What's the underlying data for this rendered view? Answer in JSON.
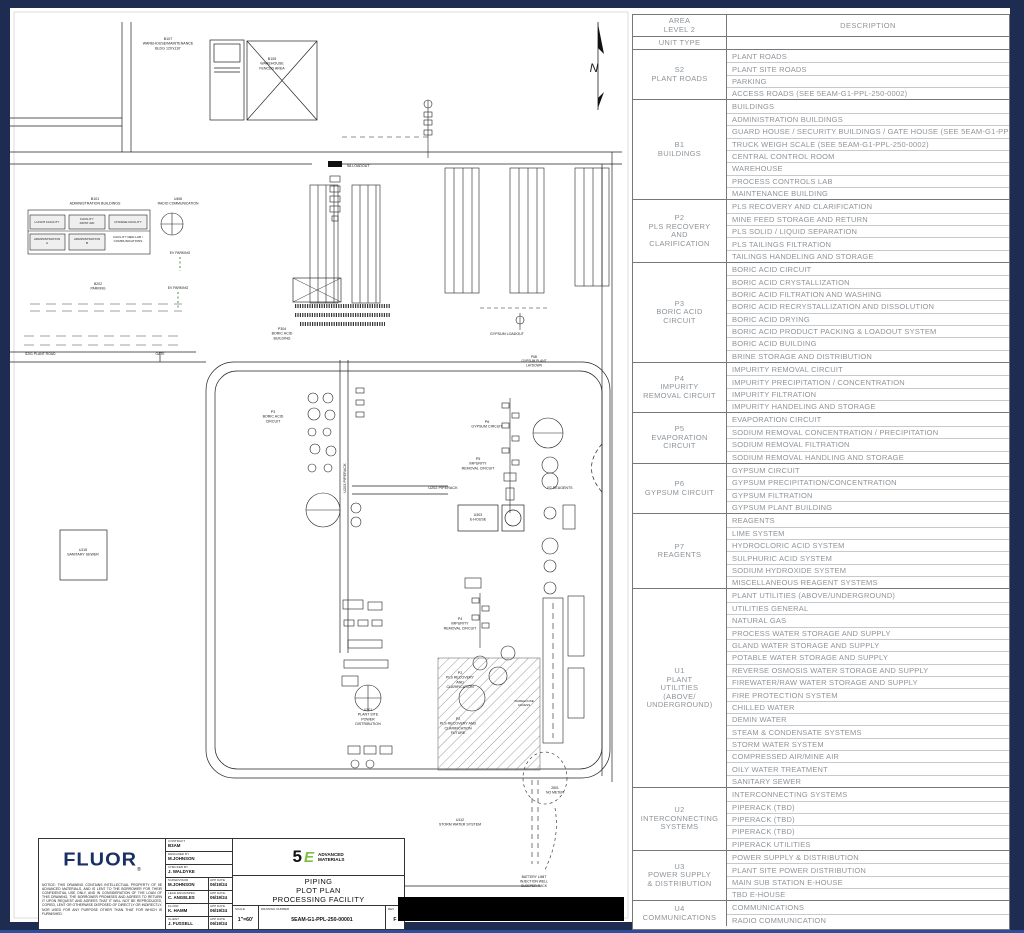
{
  "colors": {
    "frame_navy": "#1d2c50",
    "frame_accent": "#2c4e9b",
    "sheet_white": "#ffffff",
    "line_black": "#1a1a1a",
    "table_text_gray": "#8f9499",
    "fluor_blue": "#1a2f63",
    "five_e_green": "#7fbf3f",
    "ev_green": "#3a9948",
    "redaction_black": "#000000"
  },
  "plot_labels": [
    {
      "name": "north",
      "lines": [
        "N"
      ],
      "x": 584,
      "y": 64,
      "size": 12,
      "style": "italic"
    },
    {
      "name": "b107-warehouse-maintenance",
      "lines": [
        "B107",
        "WAREHOUSE/MAINTENANCE",
        "BLDG 120'x110'"
      ],
      "x": 158,
      "y": 32,
      "size": 3.6
    },
    {
      "name": "b105-warehouse-fenced-area",
      "lines": [
        "B105",
        "WAREHOUSE",
        "FENCED AREA"
      ],
      "x": 262,
      "y": 52,
      "size": 3.6
    },
    {
      "name": "b101-administration-buildings",
      "lines": [
        "B101",
        "ADMINISTRATION BUILDINGS"
      ],
      "x": 85,
      "y": 192,
      "size": 3.6
    },
    {
      "name": "lunch-facility",
      "lines": [
        "LUNCH FACILITY"
      ],
      "x": 37,
      "y": 215,
      "size": 3.1
    },
    {
      "name": "facility-first-aid",
      "lines": [
        "FACILITY",
        "FIRST AID"
      ],
      "x": 77,
      "y": 212,
      "size": 3.1
    },
    {
      "name": "change-facility",
      "lines": [
        "CHANGE FACILITY"
      ],
      "x": 118,
      "y": 215,
      "size": 3.1
    },
    {
      "name": "administration-a",
      "lines": [
        "ADMINISTRATION",
        "A"
      ],
      "x": 37,
      "y": 232,
      "size": 3.1
    },
    {
      "name": "administration-b",
      "lines": [
        "ADMINISTRATION",
        "B"
      ],
      "x": 77,
      "y": 232,
      "size": 3.1
    },
    {
      "name": "facility-med-lab",
      "lines": [
        "FACILITY MED LAB /",
        "COMMUNICATIONS"
      ],
      "x": 118,
      "y": 230,
      "size": 3.1
    },
    {
      "name": "u408-radio-communication",
      "lines": [
        "U408",
        "RADIO COMMUNICATION"
      ],
      "x": 168,
      "y": 192,
      "size": 3.4
    },
    {
      "name": "ev-parking-1",
      "lines": [
        "EV PARKING"
      ],
      "x": 170,
      "y": 246,
      "size": 3.4
    },
    {
      "name": "b202-parking",
      "lines": [
        "B202",
        "PARKING"
      ],
      "x": 88,
      "y": 277,
      "size": 3.4
    },
    {
      "name": "ev-parking-2",
      "lines": [
        "EV PARKING"
      ],
      "x": 168,
      "y": 281,
      "size": 3.4
    },
    {
      "name": "s201-plant-road",
      "lines": [
        "S201 PLANT ROAD"
      ],
      "x": 15,
      "y": 347,
      "size": 3.4,
      "anchor": "start"
    },
    {
      "name": "gate",
      "lines": [
        "GATE"
      ],
      "x": 150,
      "y": 347,
      "size": 3.4
    },
    {
      "name": "u115-sanitary-sewer",
      "lines": [
        "U115",
        "SANITARY SEWER"
      ],
      "x": 73,
      "y": 543,
      "size": 3.6
    },
    {
      "name": "5a-loadout",
      "lines": [
        "5A LOADOUT"
      ],
      "x": 337,
      "y": 159,
      "size": 3.6,
      "anchor": "start"
    },
    {
      "name": "p304-boric-acid-building",
      "lines": [
        "P304",
        "BORIC ACID",
        "BUILDING"
      ],
      "x": 272,
      "y": 322,
      "size": 3.6
    },
    {
      "name": "p3-boric-acid-circuit",
      "lines": [
        "P3",
        "BORIC ACID",
        "CIRCUIT"
      ],
      "x": 263,
      "y": 405,
      "size": 3.6
    },
    {
      "name": "u203-piperack",
      "lines": [
        "U203 PIPERACK"
      ],
      "x": 336,
      "y": 470,
      "size": 3.8,
      "rotate": -90
    },
    {
      "name": "gypsum-loadout",
      "lines": [
        "GYPSUM LOADOUT"
      ],
      "x": 497,
      "y": 327,
      "size": 3.6
    },
    {
      "name": "p6b-gypsum-loadout",
      "lines": [
        "P6B",
        "GYPSUM PLANT",
        "LAYDOWN"
      ],
      "x": 524,
      "y": 350,
      "size": 3.2
    },
    {
      "name": "p6-gypsum-circuit",
      "lines": [
        "P6",
        "GYPSUM CIRCUIT"
      ],
      "x": 477,
      "y": 415,
      "size": 3.6
    },
    {
      "name": "p5-impurity-removal-circuit",
      "lines": [
        "P5",
        "IMPURITY",
        "REMOVAL CIRCUIT"
      ],
      "x": 468,
      "y": 452,
      "size": 3.6
    },
    {
      "name": "u202-piperack",
      "lines": [
        "U202 PIPERACK"
      ],
      "x": 433,
      "y": 481,
      "size": 3.8
    },
    {
      "name": "u303-e-house",
      "lines": [
        "U303",
        "E-HOUSE"
      ],
      "x": 468,
      "y": 508,
      "size": 3.6
    },
    {
      "name": "p7-reagents",
      "lines": [
        "P7 REAGENTS"
      ],
      "x": 550,
      "y": 481,
      "size": 3.6
    },
    {
      "name": "p4-impurity-removal-circuit",
      "lines": [
        "P4",
        "IMPURITY",
        "REMOVAL CIRCUIT"
      ],
      "x": 450,
      "y": 612,
      "size": 3.6
    },
    {
      "name": "p2-pls-recovery",
      "lines": [
        "P2",
        "PLS RECOVERY",
        "AND",
        "CLARIFICATION"
      ],
      "x": 450,
      "y": 666,
      "size": 3.6
    },
    {
      "name": "p2-pls-recovery-future",
      "lines": [
        "P2",
        "PLS RECOVERY AND",
        "CLARIFICATION",
        "FUTURE"
      ],
      "x": 448,
      "y": 712,
      "size": 3.6
    },
    {
      "name": "u301-plant-site-power",
      "lines": [
        "U301",
        "PLANT SITE",
        "POWER",
        "DISTRIBUTION"
      ],
      "x": 358,
      "y": 703,
      "size": 3.6
    },
    {
      "name": "warehouse-access",
      "lines": [
        "WAREHOUSE",
        "ACCESS"
      ],
      "x": 514,
      "y": 694,
      "size": 3
    },
    {
      "name": "u112-storm-water-system",
      "lines": [
        "U112",
        "STORM WATER SYSTEM"
      ],
      "x": 450,
      "y": 813,
      "size": 3.6
    },
    {
      "name": "no-meter",
      "lines": [
        "2801",
        "NO METER"
      ],
      "x": 545,
      "y": 781,
      "size": 3.4
    },
    {
      "name": "battery-limit",
      "lines": [
        "BATTERY LIMIT",
        "INJECTION WELL",
        "SLEEPER RACK"
      ],
      "x": 524,
      "y": 870,
      "size": 3.4
    }
  ],
  "title_block": {
    "fluor_logo": "FLUOR",
    "registered_mark": "®",
    "notice": "NOTICE: THIS DRAWING CONTAINS INTELLECTUAL PROPERTY OF 5E ADVANCED MATERIALS, AND IS LENT TO THE BORROWER FOR THEIR CONFIDENTIAL USE ONLY, AND IN CONSIDERATION OF THE LOAN OF THIS DRAWING, THE BORROWER PROMISES AND AGREES TO RETURN IT UPON REQUEST AND AGREES THAT IT WILL NOT BE REPRODUCED, COPIED, LENT OR OTHERWISE DISPOSED OF DIRECTLY OR INDIRECTLY, NOR USED FOR ANY PURPOSE OTHER THAN THAT FOR WHICH IS FURNISHED.",
    "app_date_label": "APP DATE",
    "fields": [
      {
        "label": "CONTRACT",
        "value": "B3AM"
      },
      {
        "label": "DESIGNED BY",
        "value": "M.JOHNSON"
      },
      {
        "label": "CHECKED BY",
        "value": "J. WALDYKE"
      },
      {
        "label": "SUPERVISOR",
        "value": "M.JOHNSON",
        "app_date": "06/19/24"
      },
      {
        "label": "LEAD ENGR/SPEC",
        "value": "C. ANGELES",
        "app_date": "06/19/24"
      },
      {
        "label": "FLUOR",
        "value": "K. HAMM",
        "app_date": "06/19/24"
      },
      {
        "label": "CLIENT",
        "value": "J. FUSSELL",
        "app_date": "06/19/24"
      }
    ],
    "logo_5e": {
      "numeral": "5",
      "letter": "E",
      "name_line1": "ADVANCED",
      "name_line2": "MATERIALS"
    },
    "title_lines": [
      "PIPING",
      "PLOT PLAN",
      "PROCESSING FACILITY"
    ],
    "scale_label": "SCALE",
    "scale": "1\"=60'",
    "drawing_number_label": "DRAWING NUMBER",
    "drawing_number": "5EAM-G1-PPL-250-00001",
    "rev_label": "REV",
    "rev": "F"
  },
  "area_table": {
    "header": {
      "col1_line1": "AREA",
      "col1_line2": "LEVEL 2",
      "col2": "DESCRIPTION",
      "subheader": "UNIT TYPE"
    },
    "groups": [
      {
        "label_lines": [
          "S2",
          "PLANT ROADS"
        ],
        "rows": [
          "PLANT ROADS",
          "PLANT SITE ROADS",
          "PARKING",
          "ACCESS ROADS (SEE 5EAM-G1-PPL-250-0002)"
        ]
      },
      {
        "label_lines": [
          "B1",
          "BUILDINGS"
        ],
        "rows": [
          "BUILDINGS",
          "ADMINISTRATION BUILDINGS",
          "GUARD HOUSE / SECURITY BUILDINGS / GATE HOUSE (SEE 5EAM-G1-PPL-250-0002)",
          "TRUCK WEIGH SCALE (SEE 5EAM-G1-PPL-250-0002)",
          "CENTRAL CONTROL ROOM",
          "WAREHOUSE",
          "PROCESS CONTROLS LAB",
          "MAINTENANCE BUILDING"
        ]
      },
      {
        "label_lines": [
          "P2",
          "PLS RECOVERY",
          "AND",
          "CLARIFICATION"
        ],
        "rows": [
          "PLS RECOVERY AND CLARIFICATION",
          "MINE FEED STORAGE AND RETURN",
          "PLS SOLID / LIQUID SEPARATION",
          "PLS TAILINGS FILTRATION",
          "TAILINGS HANDELING AND STORAGE"
        ]
      },
      {
        "label_lines": [
          "P3",
          "BORIC ACID",
          "CIRCUIT"
        ],
        "rows": [
          "BORIC ACID CIRCUIT",
          "BORIC ACID CRYSTALLIZATION",
          "BORIC ACID FILTRATION AND WASHING",
          "BORIC ACID RECRYSTALLIZATION AND DISSOLUTION",
          "BORIC ACID DRYING",
          "BORIC ACID PRODUCT PACKING & LOADOUT SYSTEM",
          "BORIC ACID BUILDING",
          "BRINE STORAGE AND DISTRIBUTION"
        ]
      },
      {
        "label_lines": [
          "P4",
          "IMPURITY",
          "REMOVAL CIRCUIT"
        ],
        "rows": [
          "IMPURITY REMOVAL CIRCUIT",
          "IMPURITY PRECIPITATION / CONCENTRATION",
          "IMPURITY FILTRATION",
          "IMPURITY HANDELING AND STORAGE"
        ]
      },
      {
        "label_lines": [
          "P5",
          "EVAPORATION",
          "CIRCUIT"
        ],
        "rows": [
          "EVAPORATION CIRCUIT",
          "SODIUM REMOVAL CONCENTRATION / PRECIPITATION",
          "SODIUM REMOVAL FILTRATION",
          "SODIUM REMOVAL HANDLING AND STORAGE"
        ]
      },
      {
        "label_lines": [
          "P6",
          "GYPSUM CIRCUIT"
        ],
        "rows": [
          "GYPSUM CIRCUIT",
          "GYPSUM PRECIPITATION/CONCENTRATION",
          "GYPSUM FILTRATION",
          "GYPSUM PLANT BUILDING"
        ]
      },
      {
        "label_lines": [
          "P7",
          "REAGENTS"
        ],
        "rows": [
          "REAGENTS",
          "LIME SYSTEM",
          "HYDROCLORIC ACID SYSTEM",
          "SULPHURIC ACID SYSTEM",
          "SODIUM HYDROXIDE SYSTEM",
          "MISCELLANEOUS REAGENT SYSTEMS"
        ]
      },
      {
        "label_lines": [
          "U1",
          "PLANT",
          "UTILITIES",
          "(ABOVE/",
          "UNDERGROUND)"
        ],
        "rows": [
          "PLANT UTILITIES (ABOVE/UNDERGROUND)",
          "UTILITIES GENERAL",
          "NATURAL GAS",
          "PROCESS WATER STORAGE AND SUPPLY",
          "GLAND WATER STORAGE AND SUPPLY",
          "POTABLE WATER STORAGE AND SUPPLY",
          "REVERSE OSMOSIS WATER STORAGE AND SUPPLY",
          "FIREWATER/RAW WATER STORAGE AND SUPPLY",
          "FIRE PROTECTION SYSTEM",
          "CHILLED WATER",
          "DEMIN WATER",
          "STEAM & CONDENSATE SYSTEMS",
          "STORM WATER SYSTEM",
          "COMPRESSED AIR/MINE AIR",
          "OILY WATER TREATMENT",
          "SANITARY SEWER"
        ]
      },
      {
        "label_lines": [
          "U2",
          "INTERCONNECTING",
          "SYSTEMS"
        ],
        "rows": [
          "INTERCONNECTING SYSTEMS",
          "PIPERACK (TBD)",
          "PIPERACK (TBD)",
          "PIPERACK  (TBD)",
          "PIPERACK UTILITIES"
        ]
      },
      {
        "label_lines": [
          "U3",
          "POWER SUPPLY",
          "& DISTRIBUTION"
        ],
        "rows": [
          "POWER SUPPLY & DISTRIBUTION",
          "PLANT SITE POWER DISTRIBUTION",
          "MAIN SUB STATION E-HOUSE",
          "TBD E-HOUSE"
        ]
      },
      {
        "label_lines": [
          "U4",
          "COMMUNICATIONS"
        ],
        "rows": [
          "COMMUNICATIONS",
          "RADIO COMMUNICATION"
        ]
      }
    ]
  }
}
